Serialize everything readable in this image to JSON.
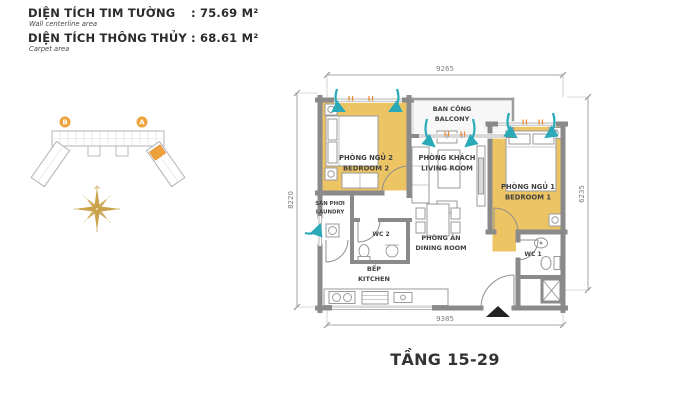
{
  "header": {
    "row1": {
      "label": "DIỆN TÍCH TIM TƯỜNG",
      "value": ": 75.69 M²",
      "sub": "Wall centerline area"
    },
    "row2": {
      "label": "DIỆN TÍCH THÔNG THỦY",
      "value": ": 68.61 M²",
      "sub": "Carpet area"
    }
  },
  "keyplan": {
    "tower_b": "B",
    "tower_a": "A"
  },
  "plan": {
    "rooms": {
      "balcony": {
        "vi": "BAN CÔNG",
        "en": "BALCONY"
      },
      "bedroom2": {
        "vi": "PHÒNG NGỦ 2",
        "en": "BEDROOM 2"
      },
      "living": {
        "vi": "PHÒNG KHÁCH",
        "en": "LIVING ROOM"
      },
      "bedroom1": {
        "vi": "PHÒNG NGỦ 1",
        "en": "BEDROOM 1"
      },
      "laundry": {
        "vi": "SÂN PHƠI",
        "en": "LAUNDRY"
      },
      "dining": {
        "vi": "PHÒNG ĂN",
        "en": "DINING ROOM"
      },
      "kitchen": {
        "vi": "BẾP",
        "en": "KITCHEN"
      },
      "wc2": {
        "label": "WC 2"
      },
      "wc1": {
        "label": "WC 1"
      }
    },
    "dimensions": {
      "top": "9265",
      "bottom": "9385",
      "left": "8220",
      "right": "6235"
    }
  },
  "footer": {
    "floor_title": "TẦNG 15-29"
  },
  "colors": {
    "room_highlight": "#ECC464",
    "wall": "#8A8A8A",
    "airflow": "#2AA9B8",
    "accent_orange": "#EFA23B",
    "compass_gold": "#C9A24B"
  }
}
